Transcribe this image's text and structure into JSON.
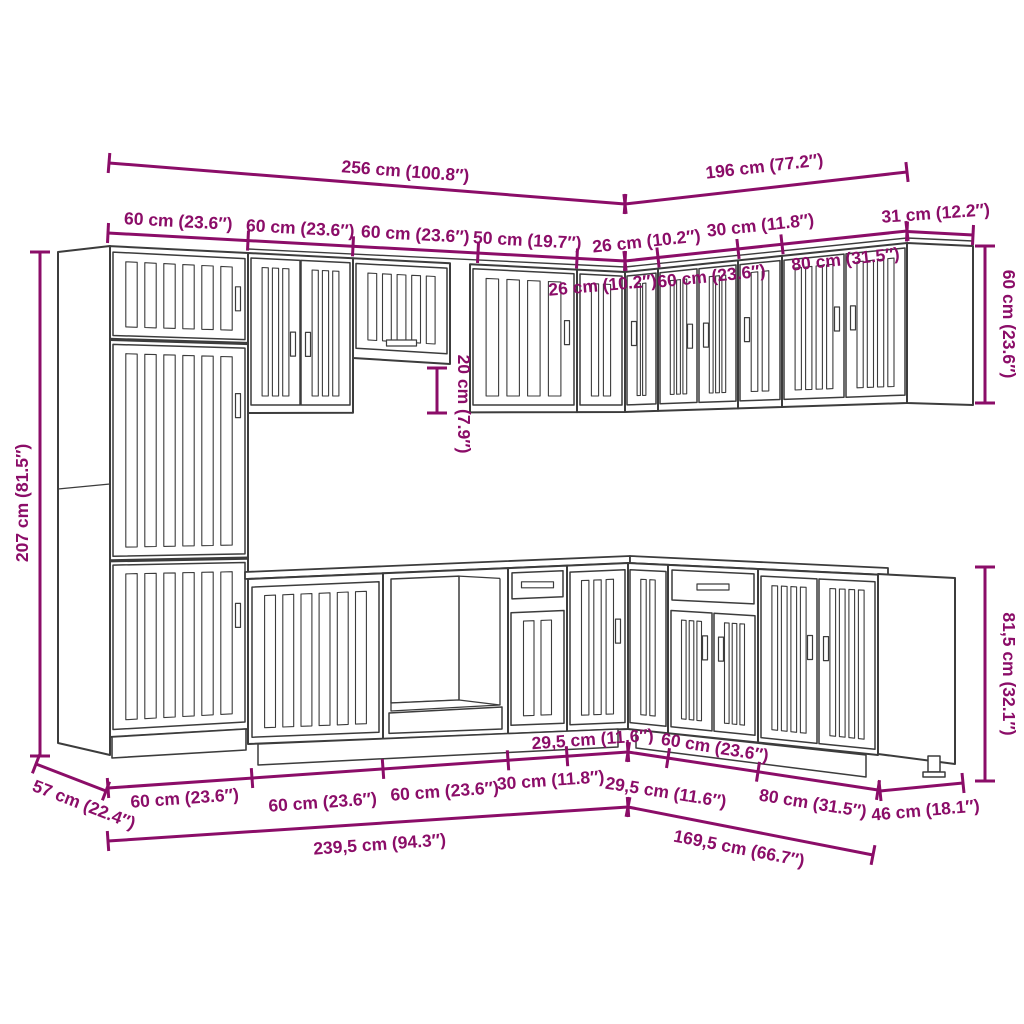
{
  "diagram": {
    "type": "kitchen-cabinet-set-dimension-diagram",
    "colors": {
      "dimension": "#8B0D68",
      "linework": "#3C3C3C",
      "background": "#FFFFFF"
    },
    "dimensions": {
      "top_total_left": "256 cm (100.8″)",
      "top_total_right": "196 cm (77.2″)",
      "wall_left_1": "60 cm (23.6″)",
      "wall_left_2": "60 cm (23.6″)",
      "wall_left_3": "60 cm (23.6″)",
      "wall_left_4": "50 cm (19.7″)",
      "wall_corner_left": "26 cm (10.2″)",
      "wall_right_1": "26 cm (10.2″)",
      "wall_right_2": "60 cm (23.6″)",
      "wall_right_3": "30 cm (11.8″)",
      "wall_right_4": "80 cm (31.5″)",
      "wall_right_return": "31 cm (12.2″)",
      "height_tall": "207 cm (81.5″)",
      "wall_gap": "20 cm (7.9″)",
      "wall_height_right": "60 cm (23.6″)",
      "base_height_right": "81,5 cm (32.1″)",
      "depth_left": "57 cm (22.4″)",
      "base_left_1": "60 cm (23.6″)",
      "base_left_2": "60 cm (23.6″)",
      "base_left_3": "60 cm (23.6″)",
      "base_left_4": "30 cm (11.8″)",
      "base_corner_left": "29,5 cm (11.6″)",
      "base_right_1": "29,5 cm (11.6″)",
      "base_right_2": "60 cm (23.6″)",
      "base_right_3": "80 cm (31.5″)",
      "depth_right": "46 cm (18.1″)",
      "bottom_total_left": "239,5 cm (94.3″)",
      "bottom_total_right": "169,5 cm (66.7″)"
    }
  }
}
